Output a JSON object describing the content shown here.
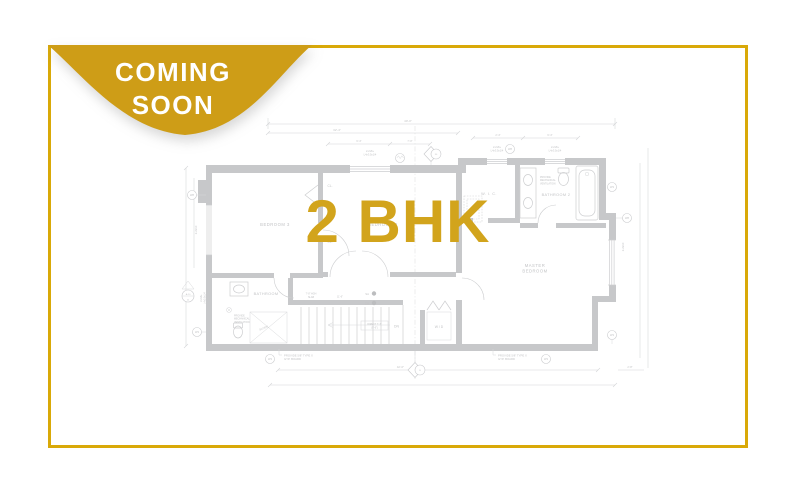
{
  "badge": {
    "line1": "COMING",
    "line2": "SOON"
  },
  "overlay": {
    "title": "2 BHK"
  },
  "colors": {
    "badge_gold": "#CE9D17",
    "frame_gold": "#D9A908",
    "text_gold": "#D2A41C",
    "plan_wall_gray": "#c7c8ca",
    "plan_text_gray": "#c2c3c5"
  },
  "plan": {
    "rooms": {
      "bedroom3": "BEDROOM 3",
      "bedroom2": "BEDROOM 2",
      "wic": "W. I. C.",
      "bathroom2": "BATHROOM 2",
      "master1": "MASTER",
      "master2": "BEDROOM",
      "bathroom": "BATHROOM",
      "wd": "W / D",
      "cl1": "CL.",
      "cl2": "CL.",
      "dn": "DN",
      "sa": "SA",
      "co": "CO",
      "slope": "SLOPE"
    },
    "ann": {
      "hdr1a": "2-2x8+",
      "hdr1b": "L4x3.5x1/4",
      "hdr2a": "2-2x8+",
      "hdr2b": "L4x3.5x1/4",
      "hdr3a": "2-2x8+",
      "hdr3b": "L4x3.5x1/4",
      "left_hdr1": "2-2x8+",
      "left_hdr2": "L4x3.5x1/4",
      "gyp1a": "PROVIDE 5/8\" TYPE X",
      "gyp1b": "GYP. BOARD",
      "gyp2a": "PROVIDE 5/8\" TYPE X",
      "gyp2b": "GYP. BOARD",
      "vent1a": "PROVIDE",
      "vent1b": "MECHANICAL",
      "vent1c": "VENTILATION",
      "vent2a": "PROVIDE",
      "vent2b": "MECHANICAL",
      "vent2c": "VENTILATION",
      "stair_note1": "DIRECT 7'-7\"",
      "stair_note2": "(9'-6\")",
      "slab1": "7'-8\" HGH",
      "slab2": "SLAB",
      "stair_w": "11'-6\""
    },
    "dims": {
      "top1": "40'-0\"",
      "top2": "32'-4\"",
      "w1": "6'-4\"",
      "w2": "7'-0\"",
      "w3": "2'-4\"",
      "w4": "6'-4\"",
      "bottom1": "42'-0\"",
      "bottom2": "2'-8\"",
      "joist_left": "2-2x10",
      "joist_right": "2-2x10"
    },
    "tags": {
      "w8": "W8",
      "w3": "W3",
      "d30": "30",
      "b": "B",
      "a10": "A-10",
      "a": "A"
    }
  }
}
